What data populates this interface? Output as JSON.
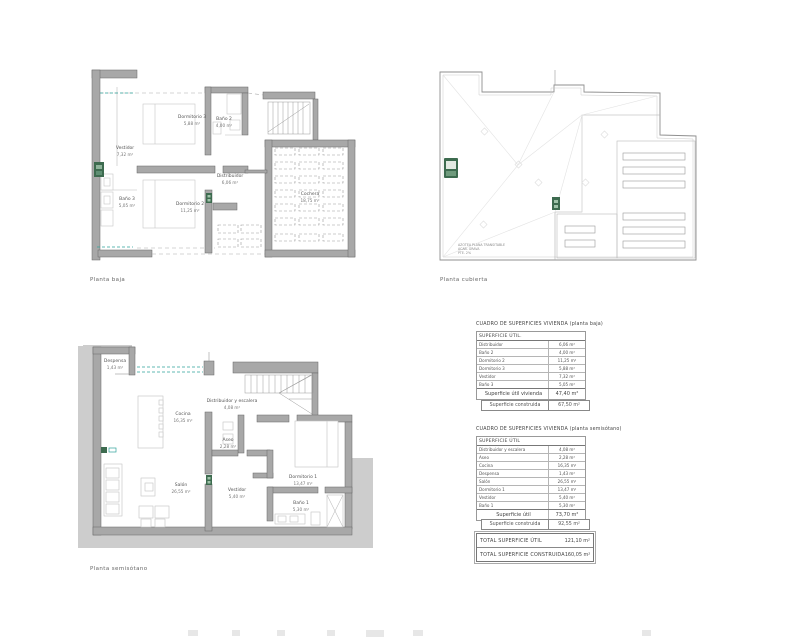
{
  "captions": {
    "baja": "Planta baja",
    "cubierta": "Planta cubierta",
    "semisotano": "Planta semisótano"
  },
  "plans": {
    "baja": {
      "rooms": [
        {
          "name": "Dormitorio 3",
          "area": "5,88 m²"
        },
        {
          "name": "Baño 2",
          "area": "4,00 m²"
        },
        {
          "name": "Vestidor",
          "area": "7,32 m²"
        },
        {
          "name": "Distribuidor",
          "area": "6,06 m²"
        },
        {
          "name": "Dormitorio 2",
          "area": "11,25 m²"
        },
        {
          "name": "Baño 3",
          "area": "5,05 m²"
        },
        {
          "name": "Cochera",
          "area": "18,75 m²"
        }
      ]
    },
    "cubierta": {
      "note": [
        "AZOTEA PLANA TRANSITABLE",
        "ACAB. GRAVA",
        "PTE. 2%"
      ]
    },
    "semisotano": {
      "rooms": [
        {
          "name": "Despensa",
          "area": "1,43 m²"
        },
        {
          "name": "Cocina",
          "area": "16,35 m²"
        },
        {
          "name": "Distribuidor y escalera",
          "area": "4,08 m²"
        },
        {
          "name": "Aseo",
          "area": "2,28 m²"
        },
        {
          "name": "Salón",
          "area": "26,55 m²"
        },
        {
          "name": "Vestidor",
          "area": "5,40 m²"
        },
        {
          "name": "Dormitorio 1",
          "area": "13,47 m²"
        },
        {
          "name": "Baño 1",
          "area": "5,30 m²"
        }
      ]
    }
  },
  "tables": {
    "baja": {
      "title": "CUADRO DE SUPERFICIES VIVIENDA (planta baja)",
      "header": "SUPERFICIE  ÚTIL.",
      "rows": [
        {
          "label": "Distribuidor",
          "value": "6,06 m²"
        },
        {
          "label": "Baño 2",
          "value": "4,00 m²"
        },
        {
          "label": "Dormitorio 2",
          "value": "11,25 m²"
        },
        {
          "label": "Dormitorio 3",
          "value": "5,88 m²"
        },
        {
          "label": "Vestidor",
          "value": "7,32 m²"
        },
        {
          "label": "Baño 3",
          "value": "5,05 m²"
        }
      ],
      "total_label": "Superficie útil vivienda",
      "total_value": "47,40 m²",
      "built_label": "Superficie construida",
      "built_value": "67,50 m²"
    },
    "semisotano": {
      "title": "CUADRO DE SUPERFICIES VIVIENDA (planta semisótano)",
      "header": "SUPERFICIE  ÚTIL",
      "rows": [
        {
          "label": "Distribuidor y escalera",
          "value": "4,08 m²"
        },
        {
          "label": "Aseo",
          "value": "2,28 m²"
        },
        {
          "label": "Cocina",
          "value": "16,35 m²"
        },
        {
          "label": "Despensa",
          "value": "1,43 m²"
        },
        {
          "label": "Salón",
          "value": "26,55 m²"
        },
        {
          "label": "Dormitorio 1",
          "value": "13,47 m²"
        },
        {
          "label": "Vestidor",
          "value": "5,40 m²"
        },
        {
          "label": "Baño 1",
          "value": "5,30 m²"
        }
      ],
      "total_label": "Superficie útil",
      "total_value": "73,70 m²",
      "built_label": "Superficie construida",
      "built_value": "92,55 m²"
    },
    "totals": {
      "rows": [
        {
          "label": "TOTAL SUPERFICIE  ÚTIL",
          "value": "121,10 m²"
        },
        {
          "label": "TOTAL SUPERFICIE  CONSTRUIDA",
          "value": "160,05 m²"
        }
      ]
    }
  }
}
